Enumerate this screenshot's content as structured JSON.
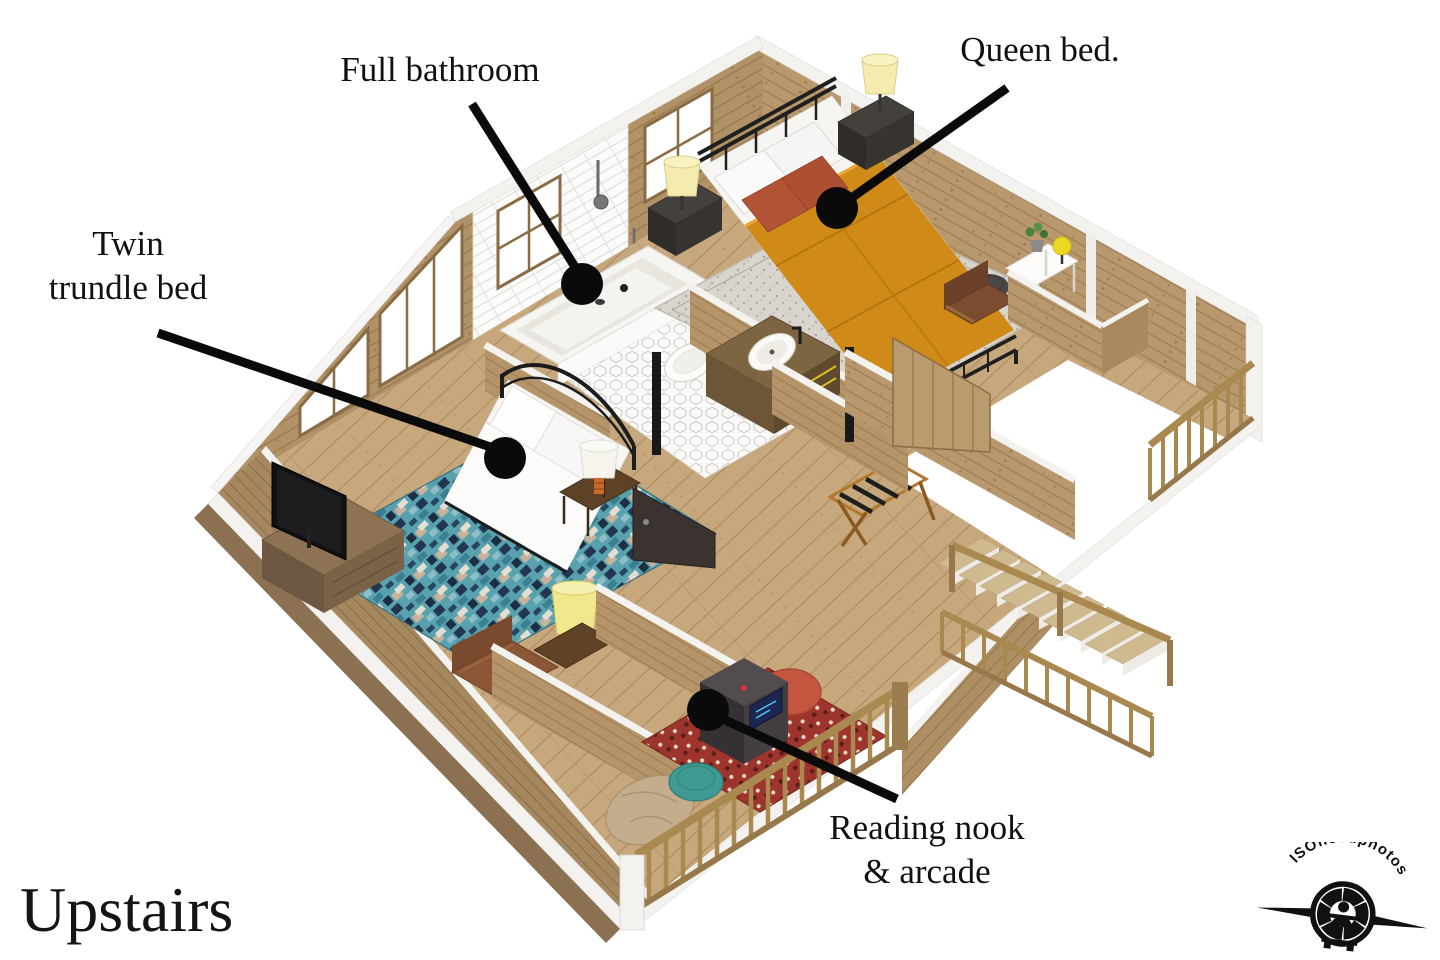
{
  "image": {
    "type": "3d-floor-plan-render",
    "background": "#ffffff"
  },
  "title": {
    "text": "Upstairs"
  },
  "watermark": {
    "text": "ISOneedphotos"
  },
  "annotations": {
    "full_bathroom": {
      "text": "Full bathroom"
    },
    "queen_bed": {
      "text": "Queen bed."
    },
    "twin_trundle": {
      "line1": "Twin",
      "line2": "trundle bed"
    },
    "reading_nook": {
      "line1": "Reading nook",
      "line2": "& arcade"
    }
  },
  "palette": {
    "wood_wall": "#b8986c",
    "wood_floor": "#c7a87d",
    "white_trim": "#f3f2ef",
    "duvet_orange": "#d08a18",
    "pillow_rust": "#b25336",
    "pouf_teal": "#3f9a93",
    "beanbag_red": "#c4553e",
    "beanbag_tan": "#c3ad8c",
    "lamp_yellow": "#f0e88c",
    "callout": "#0a0a0a"
  }
}
